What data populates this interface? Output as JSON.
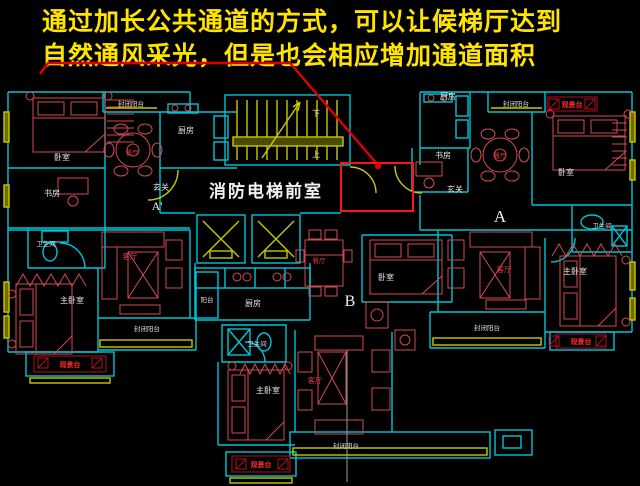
{
  "title": {
    "line1": "通过加长公共通道的方式，可以让候梯厅达到",
    "line2": "自然通风采光，但是也会相应增加通道面积"
  },
  "highlight": {
    "label": "消防电梯前室"
  },
  "terms": {
    "bedroom": "卧室",
    "master_bedroom": "主卧室",
    "study": "书房",
    "kitchen": "厨房",
    "dining": "餐厅",
    "living": "客厅",
    "bath": "卫生间",
    "entry": "玄关",
    "balcony": "阳台",
    "enclosed_balcony": "封闭阳台",
    "view_deck": "观景台",
    "up": "上",
    "down": "下"
  },
  "marks": {
    "a_prime": "A'",
    "a": "A",
    "b": "B"
  },
  "colors": {
    "background": "#000000",
    "title_text": "#ffe400",
    "wall_cyan": "#00c4d6",
    "cad_yellow": "#c9c900",
    "furniture_red": "#d34a52",
    "label_white": "#e8e8e8",
    "label_red": "#e23a46",
    "highlight_red": "#ff1414"
  }
}
